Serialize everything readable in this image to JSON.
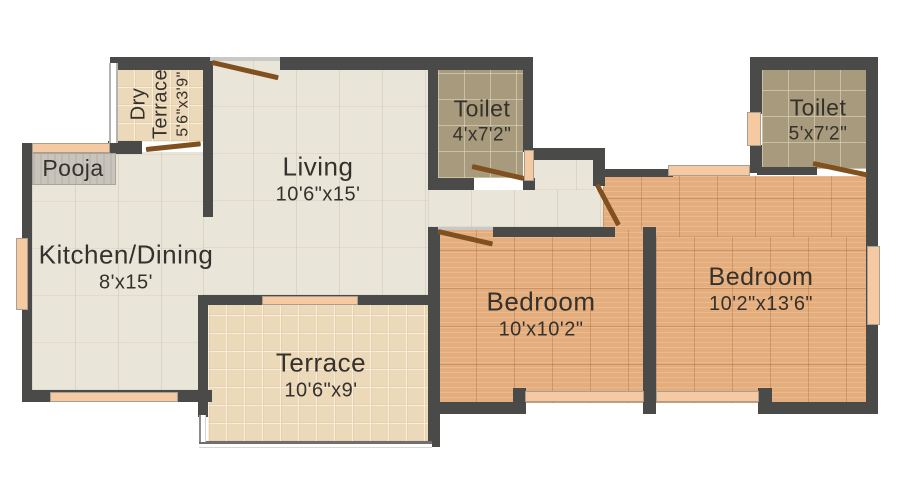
{
  "plan": {
    "rooms": {
      "pooja": {
        "name": "Pooja"
      },
      "dry_terrace": {
        "name": "Dry Terrace",
        "dims": "5'6\"x3'9\""
      },
      "living": {
        "name": "Living",
        "dims": "10'6\"x15'"
      },
      "toilet1": {
        "name": "Toilet",
        "dims": "4'x7'2\""
      },
      "toilet2": {
        "name": "Toilet",
        "dims": "5'x7'2\""
      },
      "kitchen": {
        "name": "Kitchen/Dining",
        "dims": "8'x15'"
      },
      "terrace": {
        "name": "Terrace",
        "dims": "10'6\"x9'"
      },
      "bedroom1": {
        "name": "Bedroom",
        "dims": "10'x10'2\""
      },
      "bedroom2": {
        "name": "Bedroom",
        "dims": "10'2\"x13'6\""
      }
    },
    "colors": {
      "wall": "#4a4a48",
      "floor_cream": "#e9e5d9",
      "floor_terrace_tile": "#ecd9ba",
      "floor_toilet": "#a89a7d",
      "floor_bedroom": "#e3ad7e",
      "window": "#f5c9a2",
      "door": "#80511f",
      "pooja_platform": "#c8c4bb",
      "text": "#35312c",
      "background": "#ffffff"
    }
  }
}
